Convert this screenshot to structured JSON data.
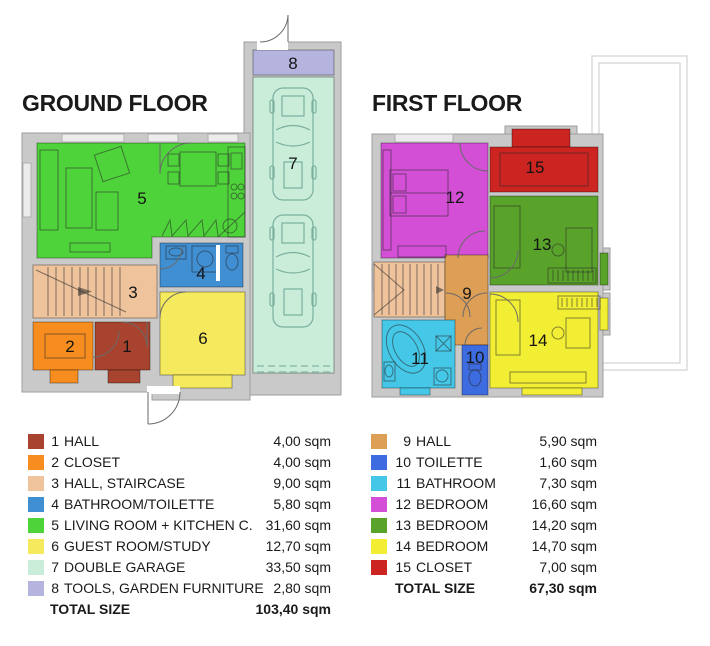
{
  "ground_floor": {
    "title": "GROUND FLOOR",
    "rooms": [
      {
        "num": "1",
        "name": "HALL",
        "size": "4,00 sqm",
        "color": "#A8432F"
      },
      {
        "num": "2",
        "name": "CLOSET",
        "size": "4,00 sqm",
        "color": "#F68D1E"
      },
      {
        "num": "3",
        "name": "HALL, STAIRCASE",
        "size": "9,00 sqm",
        "color": "#EFC39B"
      },
      {
        "num": "4",
        "name": "BATHROOM/TOILETTE",
        "size": "5,80 sqm",
        "color": "#3F8FD2"
      },
      {
        "num": "5",
        "name": "LIVING ROOM + KITCHEN C.",
        "size": "31,60 sqm",
        "color": "#4FD33A"
      },
      {
        "num": "6",
        "name": "GUEST ROOM/STUDY",
        "size": "12,70 sqm",
        "color": "#F5E95D"
      },
      {
        "num": "7",
        "name": "DOUBLE GARAGE",
        "size": "33,50 sqm",
        "color": "#C9EDD8"
      },
      {
        "num": "8",
        "name": "TOOLS, GARDEN FURNITURE",
        "size": "2,80 sqm",
        "color": "#B4B4DF"
      }
    ],
    "total_label": "TOTAL SIZE",
    "total_size": "103,40 sqm"
  },
  "first_floor": {
    "title": "FIRST FLOOR",
    "rooms": [
      {
        "num": "9",
        "name": "HALL",
        "size": "5,90 sqm",
        "color": "#DD9E56"
      },
      {
        "num": "10",
        "name": "TOILETTE",
        "size": "1,60 sqm",
        "color": "#3D6BE0"
      },
      {
        "num": "11",
        "name": "BATHROOM",
        "size": "7,30 sqm",
        "color": "#45C8E8"
      },
      {
        "num": "12",
        "name": "BEDROOM",
        "size": "16,60 sqm",
        "color": "#D24FD6"
      },
      {
        "num": "13",
        "name": "BEDROOM",
        "size": "14,20 sqm",
        "color": "#5AA32B"
      },
      {
        "num": "14",
        "name": "BEDROOM",
        "size": "14,70 sqm",
        "color": "#F2EE33"
      },
      {
        "num": "15",
        "name": "CLOSET",
        "size": "7,00 sqm",
        "color": "#CC2420"
      }
    ],
    "total_label": "TOTAL SIZE",
    "total_size": "67,30 sqm"
  },
  "palette": {
    "wall": "#C9C9C9",
    "stairs_fill": "#EFC39B",
    "car_outline": "#7AAF9F",
    "balcony_outline": "#DBDBDB",
    "text": "#1A1A1A"
  }
}
